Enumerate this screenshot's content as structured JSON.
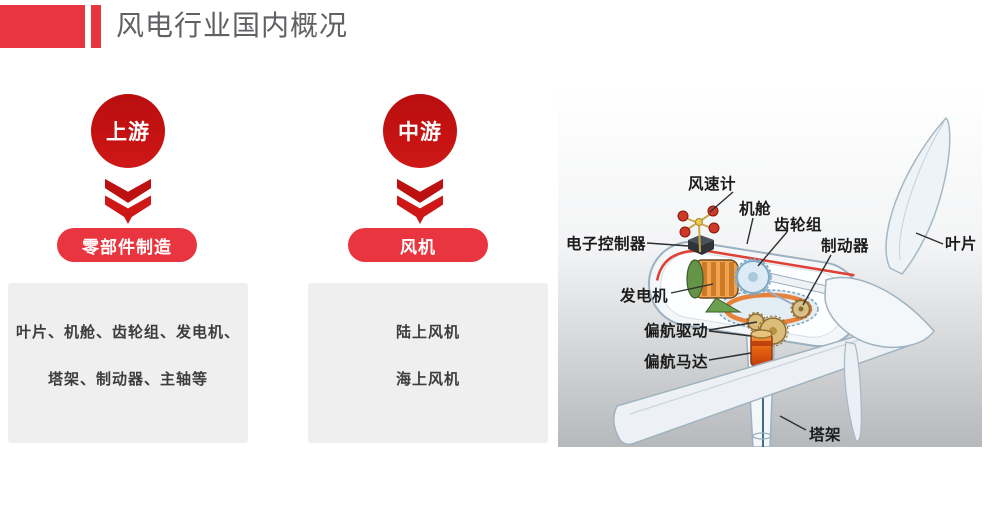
{
  "slide": {
    "title": "风电行业国内概况"
  },
  "columns": [
    {
      "stage": "上游",
      "category": "零部件制造",
      "details": [
        "叶片、机舱、齿轮组、发电机、",
        "塔架、制动器、主轴等"
      ]
    },
    {
      "stage": "中游",
      "category": "风机",
      "details": [
        "陆上风机",
        "海上风机"
      ]
    }
  ],
  "diagram": {
    "labels": {
      "anemometer": "风速计",
      "nacelle": "机舱",
      "gearbox": "齿轮组",
      "controller": "电子控制器",
      "brake": "制动器",
      "blade": "叶片",
      "generator": "发电机",
      "yaw_drive": "偏航驱动",
      "yaw_motor": "偏航马达",
      "tower": "塔架"
    }
  },
  "colors": {
    "brand_red": "#e9353f",
    "brand_red_dark": "#c11010",
    "title_gray": "#616165",
    "card_bg": "#efefef",
    "card_text": "#3d3d3d"
  }
}
